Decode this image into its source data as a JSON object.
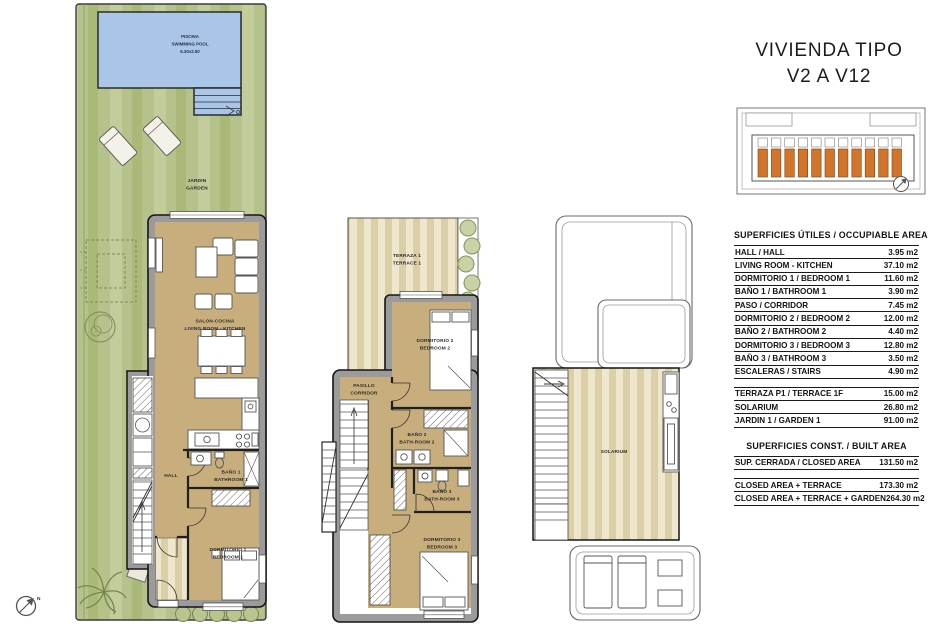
{
  "header": {
    "title_line1": "VIVIENDA TIPO",
    "title_line2": "V2 A V12"
  },
  "colors": {
    "garden_green": "#b6c28c",
    "pool_blue": "#a9c6e8",
    "floor_tan": "#c8ae7c",
    "deck_cream": "#eee7cd",
    "wall_gray": "#9b9b9b",
    "highlight_orange": "#d2742a"
  },
  "compass": {
    "north_label": "N"
  },
  "plans": {
    "ground": {
      "pool_line1": "PISCINA",
      "pool_line2": "SWIMMING POOL",
      "pool_line3": "6.30x2.50",
      "garden_line1": "JARDIN",
      "garden_line2": "GARDEN",
      "living_line1": "SALON-COCINA",
      "living_line2": "LIVING ROOM - KITCHEN",
      "hall": "HALL",
      "bath1_line1": "BAÑO 1",
      "bath1_line2": "BATHROOM 1",
      "bed1_line1": "DORMITORIO 1",
      "bed1_line2": "BEDROOM 1"
    },
    "first": {
      "terrace_line1": "TERRAZA 1",
      "terrace_line2": "TERRACE 1",
      "bed2_line1": "DORMITORIO 2",
      "bed2_line2": "BEDROOM 2",
      "corridor_line1": "PASILLO",
      "corridor_line2": "CORRIDOR",
      "bath2_line1": "BAÑO 2",
      "bath2_line2": "BATH-ROOM 2",
      "bath3_line1": "BAÑO 3",
      "bath3_line2": "BATH-ROOM 3",
      "bed3_line1": "DORMITORIO 3",
      "bed3_line2": "BEDROOM 3"
    },
    "solarium": {
      "solarium": "SOLARIUM"
    }
  },
  "tables": {
    "occupiable": {
      "title": "SUPERFICIES ÚTILES / OCCUPIABLE AREA",
      "rows": [
        {
          "label": "HALL / HALL",
          "value": "3.95 m2"
        },
        {
          "label": "LIVING ROOM - KITCHEN",
          "value": "37.10 m2"
        },
        {
          "label": "DORMITORIO 1 / BEDROOM 1",
          "value": "11.60 m2"
        },
        {
          "label": "BAÑO 1 / BATHROOM 1",
          "value": "3.90 m2"
        },
        {
          "label": "PASO / CORRIDOR",
          "value": "7.45 m2"
        },
        {
          "label": "DORMITORIO 2 / BEDROOM 2",
          "value": "12.00 m2"
        },
        {
          "label": "BAÑO 2 / BATHROOM 2",
          "value": "4.40 m2"
        },
        {
          "label": "DORMITORIO 3 / BEDROOM 3",
          "value": "12.80 m2"
        },
        {
          "label": "BAÑO 3 / BATHROOM 3",
          "value": "3.50 m2"
        },
        {
          "label": "ESCALERAS / STAIRS",
          "value": "4.90 m2"
        }
      ],
      "rows2": [
        {
          "label": "TERRAZA P1 / TERRACE 1F",
          "value": "15.00 m2"
        },
        {
          "label": "SOLARIUM",
          "value": "26.80 m2"
        },
        {
          "label": "JARDIN 1 / GARDEN 1",
          "value": "91.00 m2"
        }
      ]
    },
    "built": {
      "title": "SUPERFICIES  CONST. / BUILT AREA",
      "rows": [
        {
          "label": "SUP. CERRADA / CLOSED AREA",
          "value": "131.50 m2"
        }
      ],
      "rows2": [
        {
          "label": "CLOSED AREA + TERRACE",
          "value": "173.30 m2"
        },
        {
          "label": "CLOSED AREA + TERRACE + GARDEN",
          "value": "264.30 m2"
        }
      ]
    }
  }
}
